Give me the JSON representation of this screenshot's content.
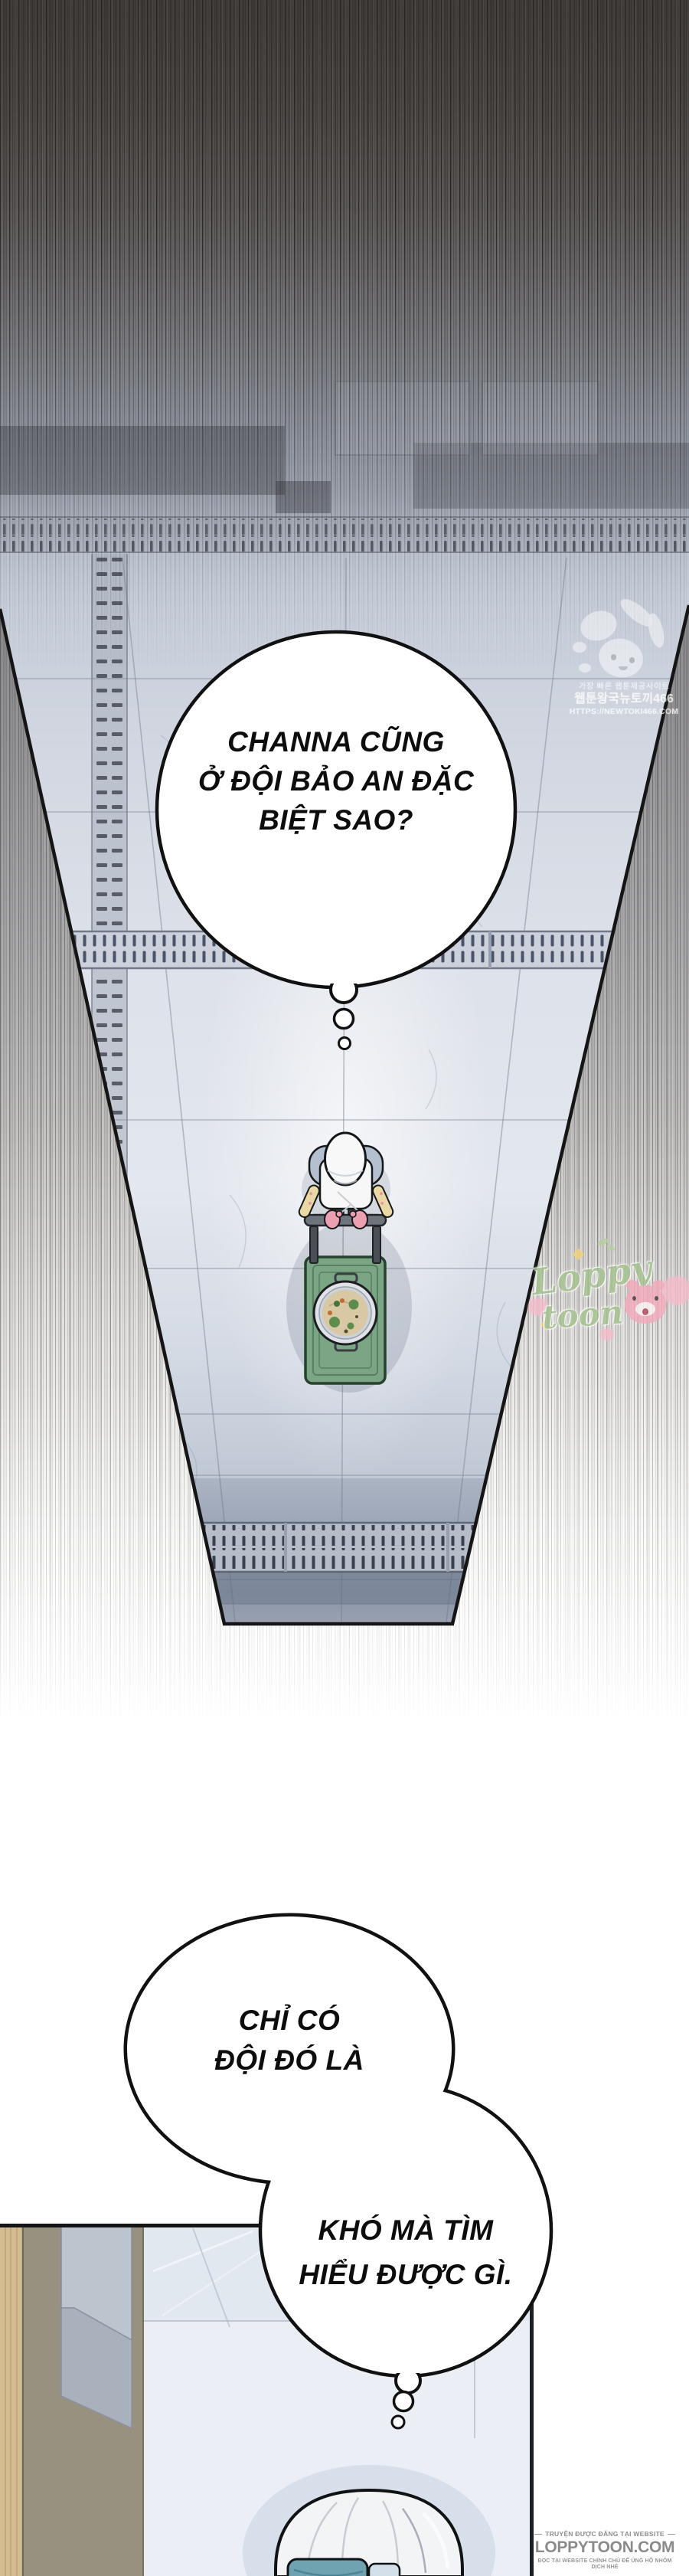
{
  "comic": {
    "bubbles": {
      "thought1": {
        "lines": [
          "CHANNA CŨNG",
          "Ở ĐỘI BẢO AN ĐẶC",
          "BIỆT SAO?"
        ]
      },
      "thought2": {
        "lines": [
          "CHỈ CÓ",
          "ĐỘI ĐÓ LÀ"
        ]
      },
      "thought3": {
        "lines": [
          "KHÓ MÀ TÌM",
          "HIỂU ĐƯỢC GÌ."
        ]
      }
    },
    "watermarks": {
      "newtoki": {
        "line1": "가장 빠른 웹툰제공사이트",
        "line2": "웹툰왕국뉴토끼466",
        "line3": "HTTPS://NEWTOKI466.COM"
      },
      "loppy_script": {
        "word1": "Loppy",
        "word2": "toon"
      },
      "site_badge": {
        "top": "TRUYỆN ĐƯỢC ĐĂNG TẠI WEBSITE",
        "main": "LOPPYTOON.COM",
        "bottom": "ĐỌC TẠI WEBSITE CHÍNH CHỦ ĐỂ ỦNG HỘ NHÓM DỊCH NHÉ"
      }
    },
    "scene": {
      "panel1": "top-down view of a hallway floor; a worker in white cap and apron pushes a green serving cart with a pot of food",
      "panel2": "room interior with door frame; person in white clean-room cap seen from behind at bottom edge"
    },
    "colors": {
      "cart_green": "#7ca585",
      "cart_outline": "#27402f",
      "floor_tile": "#d9dee7",
      "bubble_stroke": "#111111",
      "loppy_green": "#a5c28f",
      "loppy_pink": "#f3aabb",
      "sparkle_yellow": "#f2d478",
      "badge_gray": "#8e8e8e",
      "mask_teal": "#6fa3b2",
      "wood": "#d5bd93",
      "taupe": "#999180"
    }
  }
}
